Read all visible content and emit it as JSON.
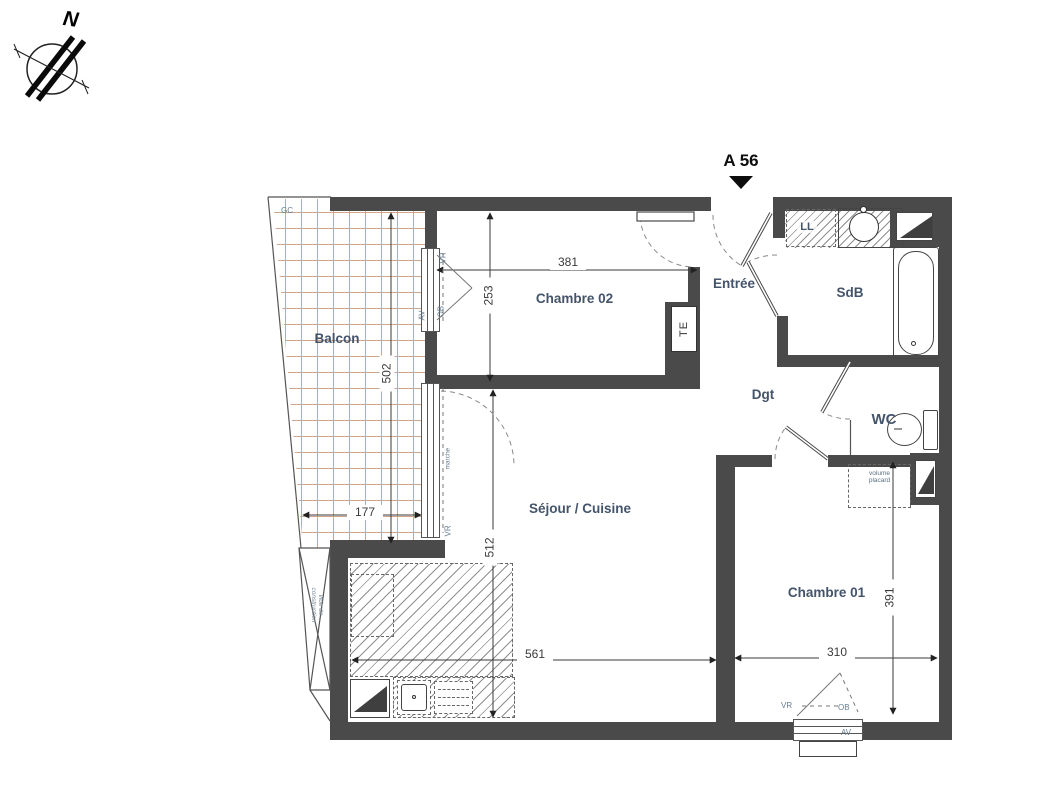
{
  "plan": {
    "unit": "A 56",
    "compass_letter": "N",
    "rooms": {
      "balcon": "Balcon",
      "chambre02": "Chambre 02",
      "entree": "Entrée",
      "sdb": "SdB",
      "dgt": "Dgt",
      "wc": "WC",
      "sejour_cuisine": "Séjour / Cuisine",
      "chambre01": "Chambre 01"
    },
    "equipment": {
      "ll": "LL",
      "te": "TE",
      "gc": "GC",
      "marche": "marche",
      "volume_placard_line1": "volume",
      "volume_placard_line2": "placard",
      "vide_line1": "vide de",
      "vide_line2": "construction"
    },
    "window_tags": {
      "av": "AV",
      "vr": "VR",
      "ob": "OB"
    },
    "dimensions_cm": {
      "chambre02_width": "381",
      "chambre02_depth": "253",
      "balcon_depth": "502",
      "balcon_width": "177",
      "sejour_depth": "512",
      "sejour_width": "561",
      "chambre01_width": "310",
      "chambre01_depth": "391"
    },
    "colors": {
      "wall": "#4a4a4a",
      "room_label": "#44546b",
      "dimension": "#3a3a3a",
      "tag": "#677d92",
      "balcony_grid": "#cda58a"
    }
  }
}
